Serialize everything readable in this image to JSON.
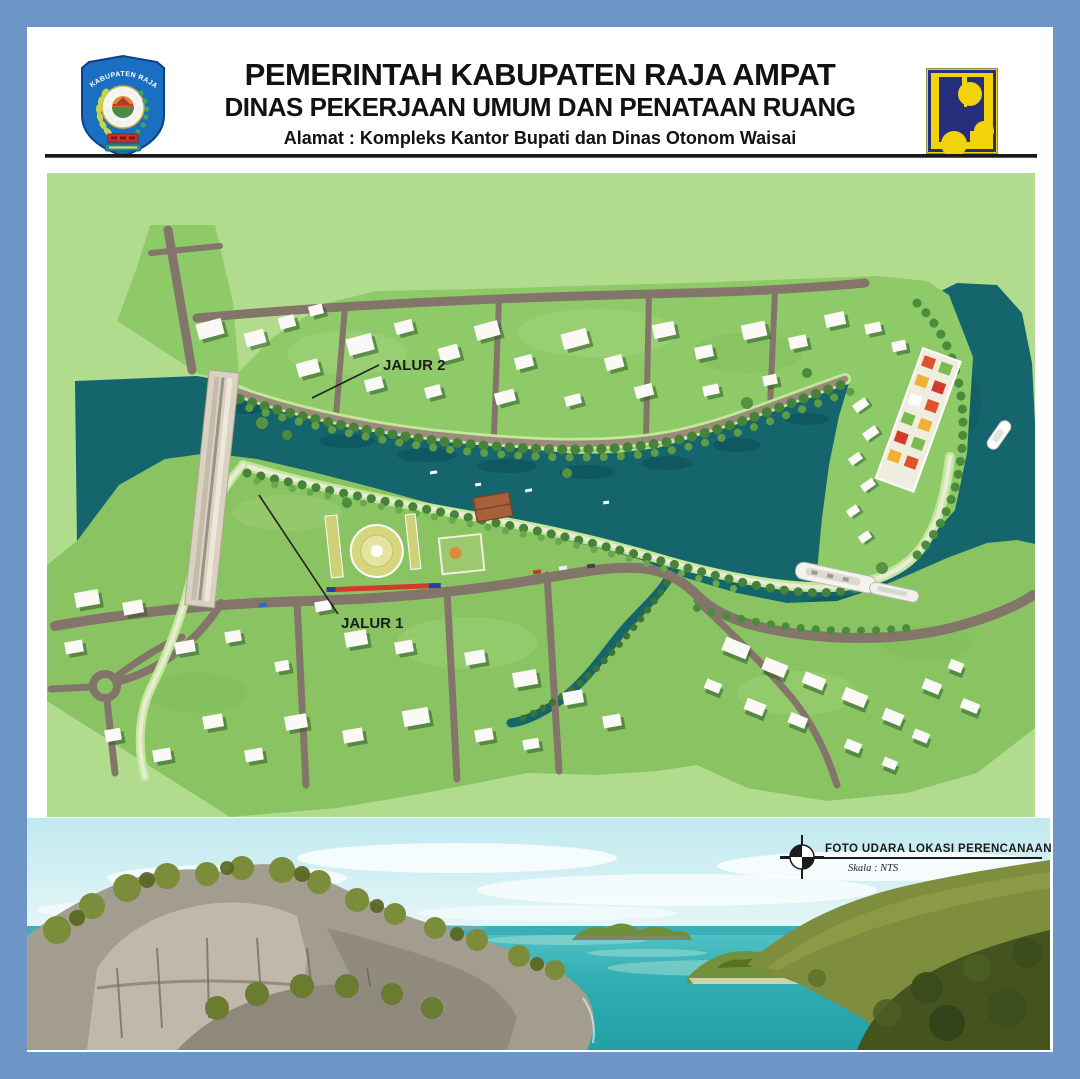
{
  "header": {
    "title": "PEMERINTAH KABUPATEN RAJA AMPAT",
    "subtitle": "DINAS PEKERJAAN UMUM DAN PENATAAN RUANG",
    "address": "Alamat : Kompleks Kantor Bupati dan Dinas Otonom Waisai",
    "seal_caption": "KABUPATEN RAJA AMPAT"
  },
  "map": {
    "labels": {
      "jalur2": "JALUR 2",
      "jalur1": "JALUR 1"
    }
  },
  "caption": {
    "title": "FOTO UDARA LOKASI PERENCANAAN",
    "scale_label": "Skala : NTS"
  },
  "colors": {
    "frame_blue": "#6d95c5",
    "map_base_green": "#b1dc8e",
    "terrain_green": "#8dc765",
    "water_teal": "#15656d",
    "road_brown": "#84756a",
    "pu_logo_yellow": "#f2d20a",
    "pu_logo_navy": "#252f7c",
    "seal_blue": "#1b6fc1"
  }
}
